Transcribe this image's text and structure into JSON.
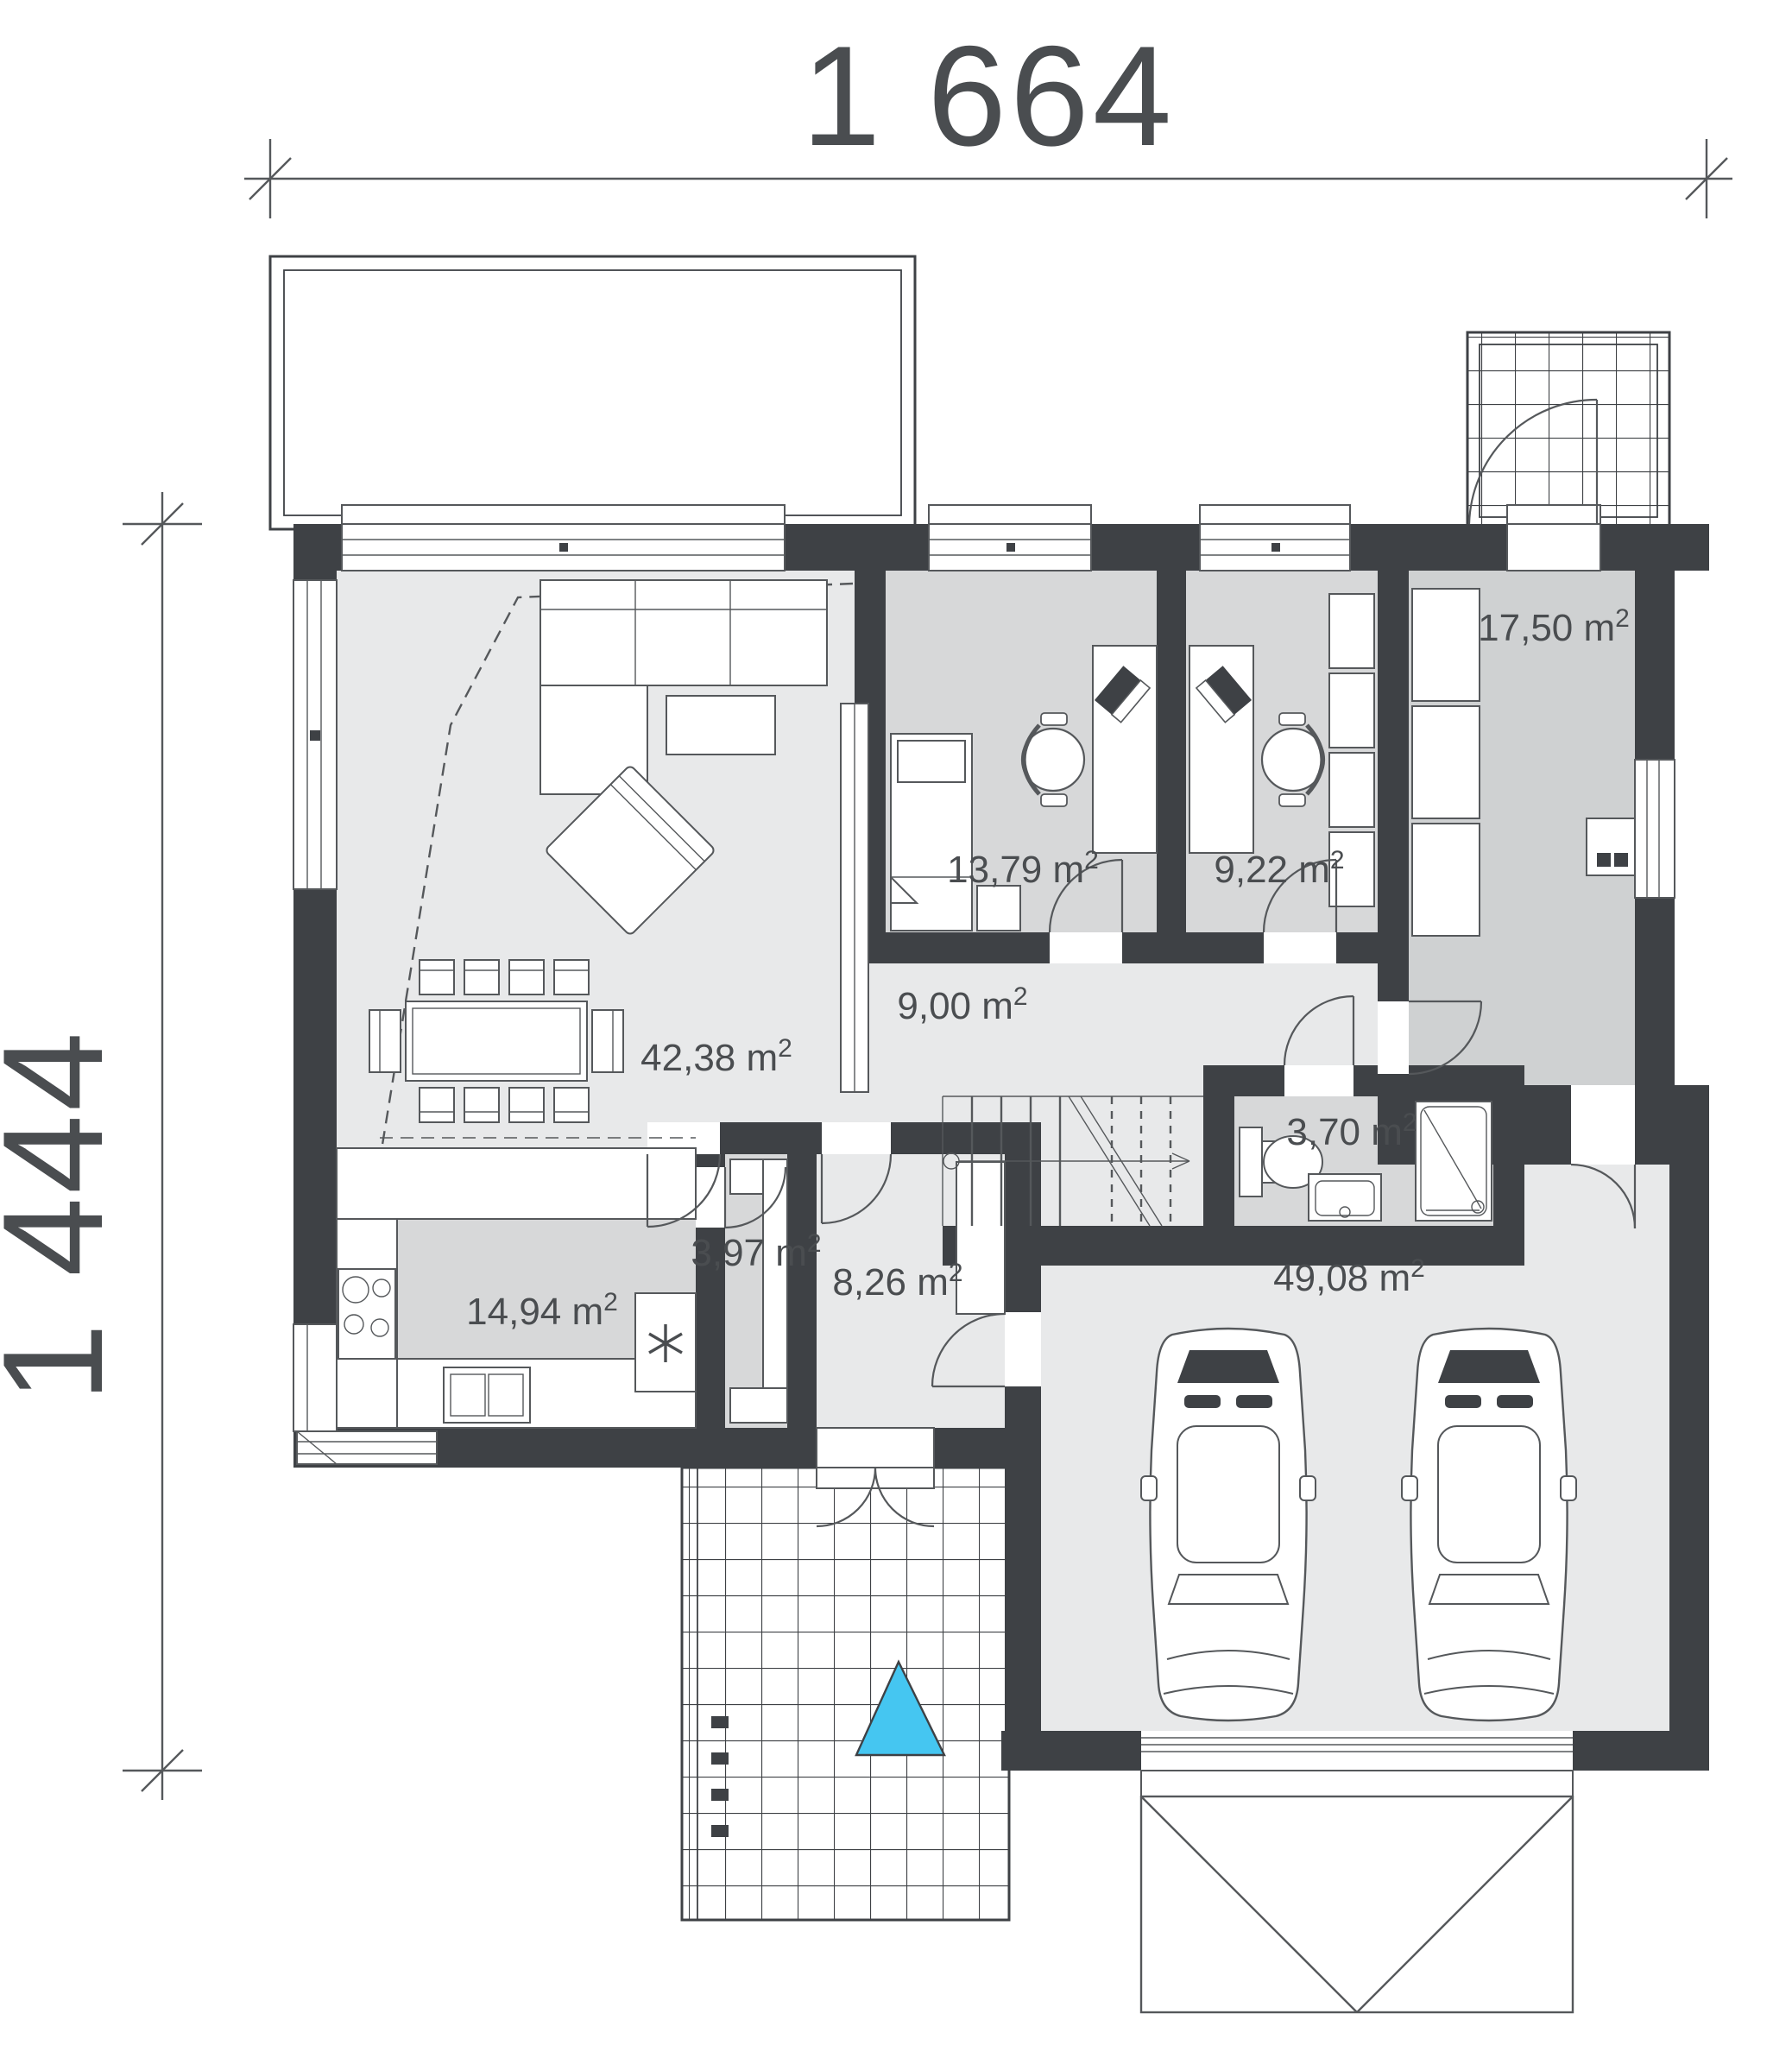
{
  "plan": {
    "type": "architectural-floor-plan",
    "dimensions": {
      "top": "1 664",
      "left": "1 444"
    },
    "rooms": {
      "living": {
        "label": "42,38 m",
        "sup": "2"
      },
      "bedroom1": {
        "label": "13,79 m",
        "sup": "2"
      },
      "bedroom2": {
        "label": "9,22 m",
        "sup": "2"
      },
      "bedroom3": {
        "label": "17,50 m",
        "sup": "2"
      },
      "hall": {
        "label": "9,00 m",
        "sup": "2"
      },
      "bathroom": {
        "label": "3,70 m",
        "sup": "2"
      },
      "kitchen": {
        "label": "14,94 m",
        "sup": "2"
      },
      "pantry": {
        "label": "3,97 m",
        "sup": "2"
      },
      "entry": {
        "label": "8,26 m",
        "sup": "2"
      },
      "garage": {
        "label": "49,08 m",
        "sup": "2"
      }
    },
    "colors": {
      "wall": "#3e4145",
      "floor_light": "#e8e9ea",
      "floor_mid": "#d7d8d9",
      "floor_dark": "#cfd1d2",
      "line": "#55585b",
      "text": "#4a4d50",
      "entrance_marker": "#45c6f1",
      "background": "#ffffff"
    }
  }
}
